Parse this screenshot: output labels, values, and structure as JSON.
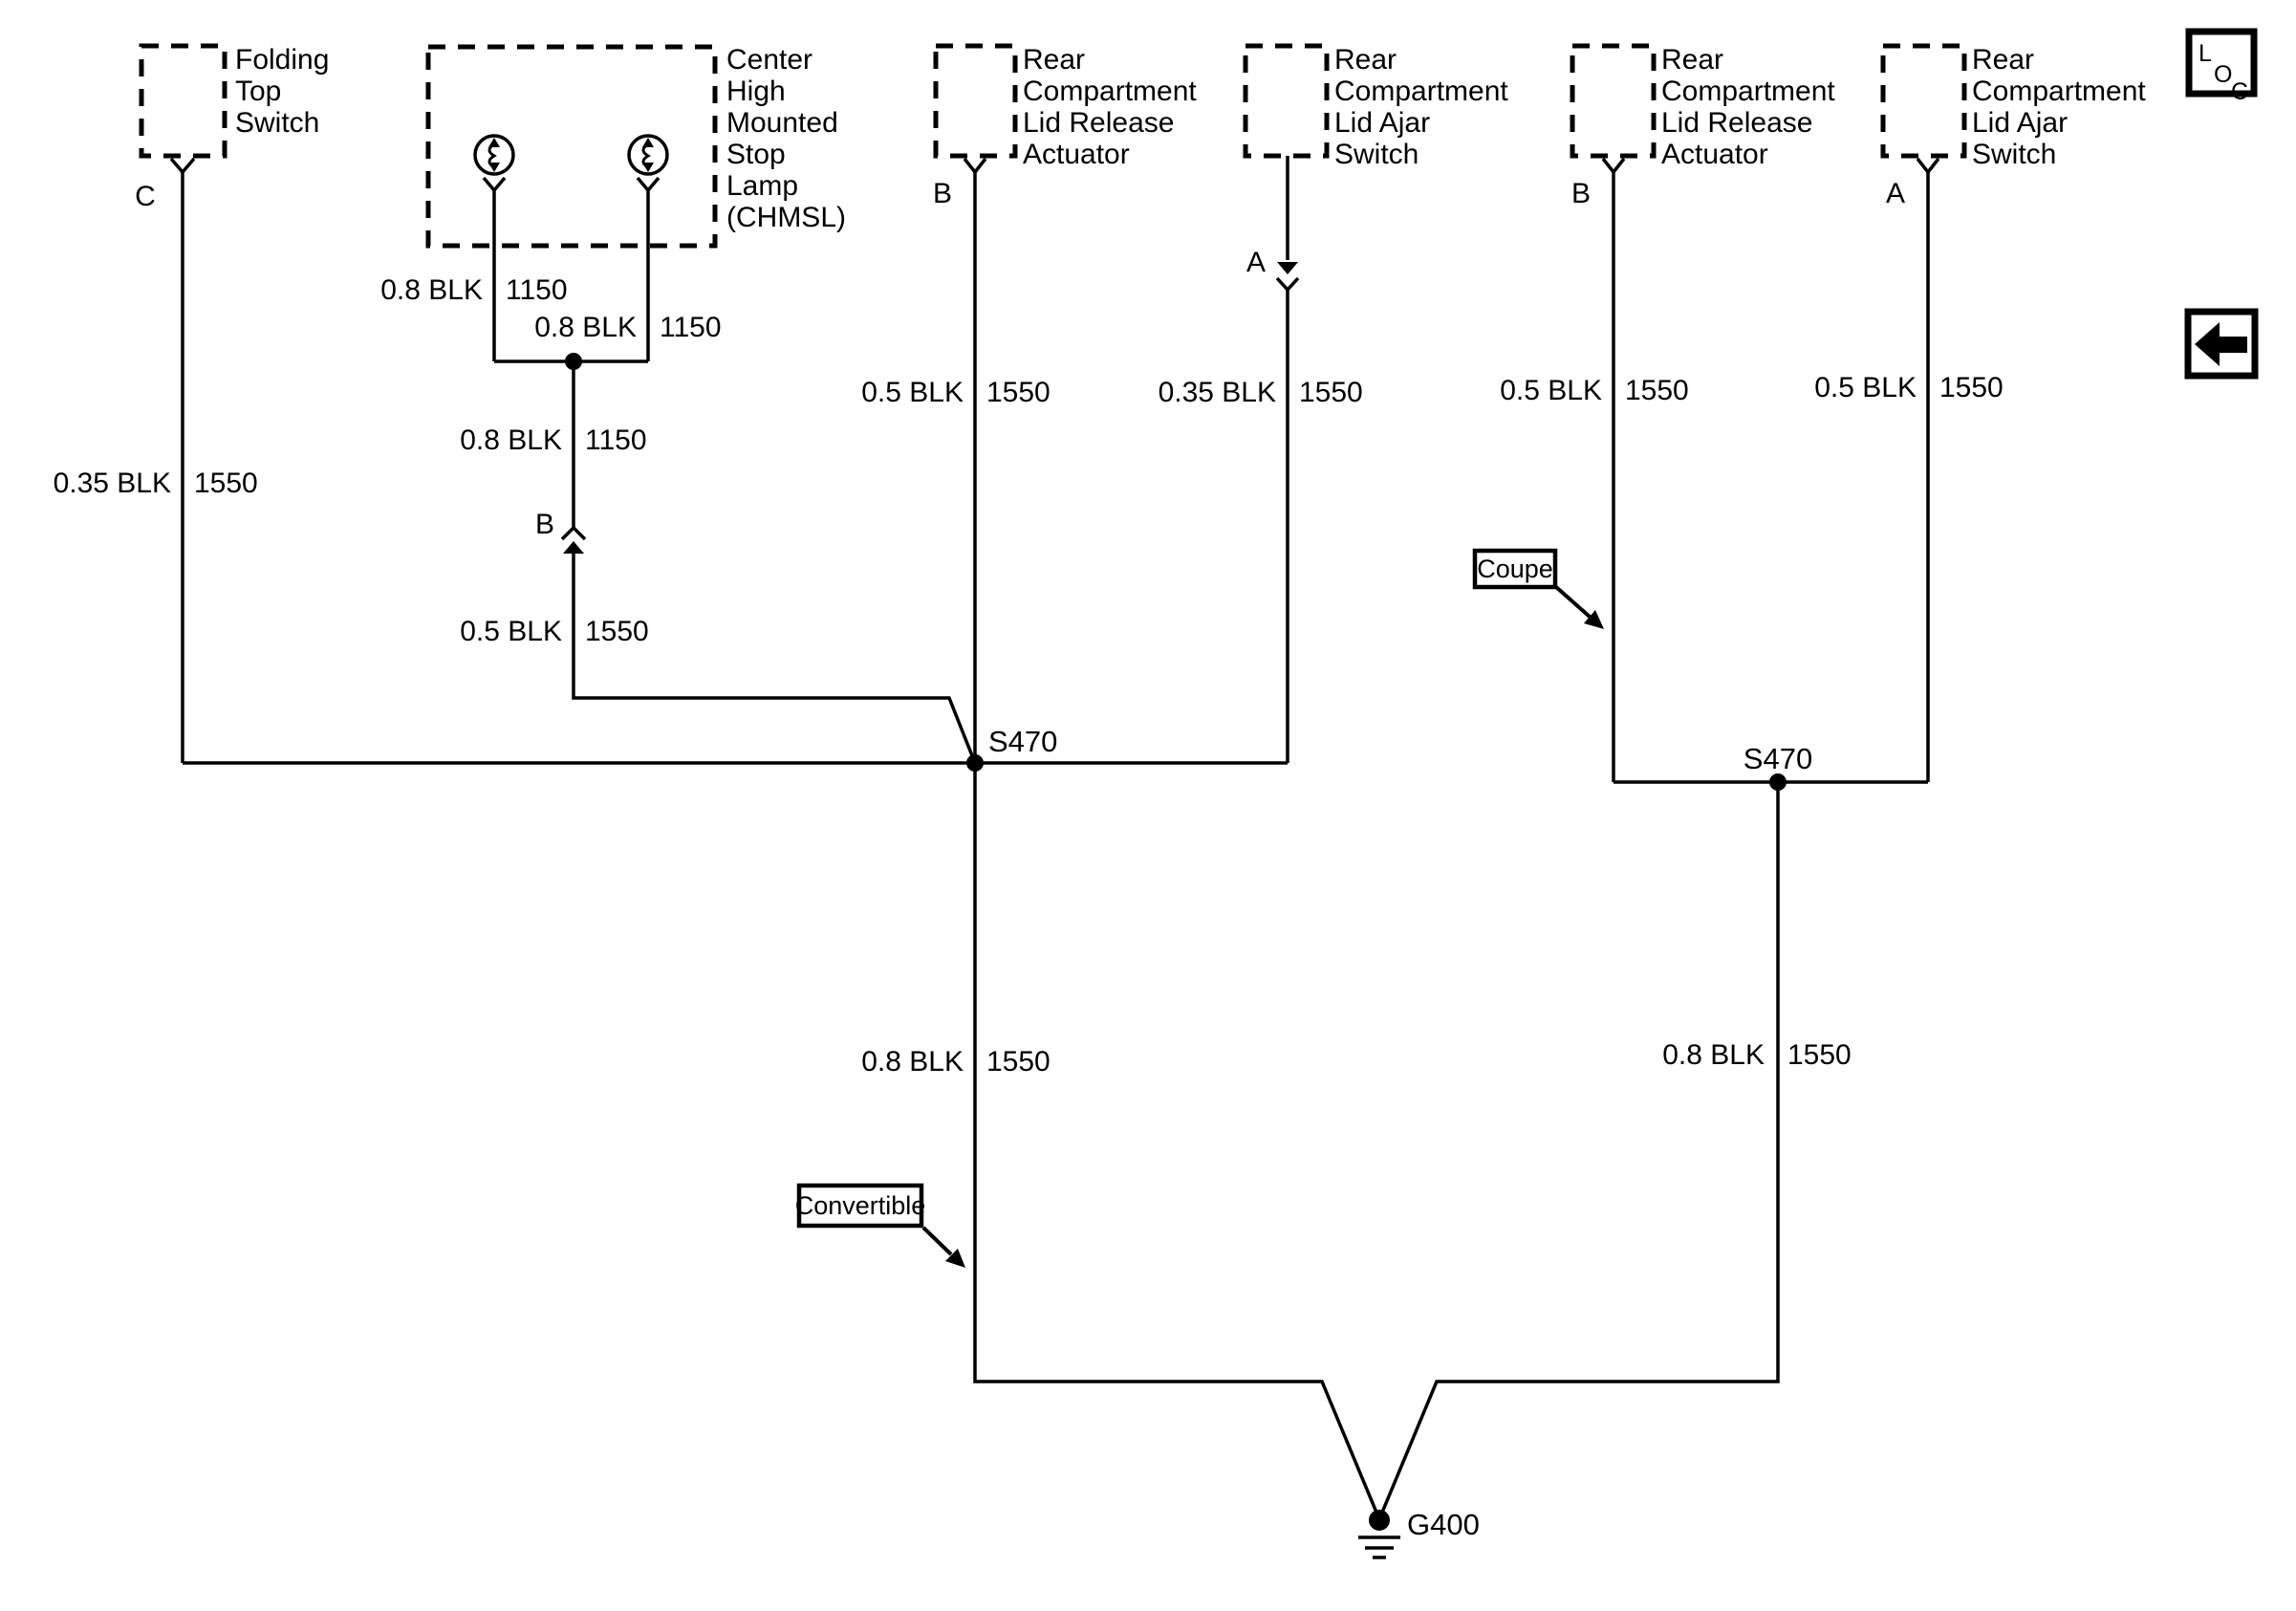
{
  "diagram": {
    "components": {
      "folding_top_switch": {
        "lines": [
          "Folding",
          "Top",
          "Switch"
        ],
        "pin": "C"
      },
      "chmsl": {
        "lines": [
          "Center",
          "High",
          "Mounted",
          "Stop",
          "Lamp",
          "(CHMSL)"
        ],
        "inline_pin": "B"
      },
      "mid_release_actuator": {
        "lines": [
          "Rear",
          "Compartment",
          "Lid Release",
          "Actuator"
        ],
        "pin": "B"
      },
      "mid_ajar_switch": {
        "lines": [
          "Rear",
          "Compartment",
          "Lid Ajar",
          "Switch"
        ],
        "inline_pin": "A"
      },
      "right_release_actuator": {
        "lines": [
          "Rear",
          "Compartment",
          "Lid Release",
          "Actuator"
        ],
        "pin": "B"
      },
      "right_ajar_switch": {
        "lines": [
          "Rear",
          "Compartment",
          "Lid Ajar",
          "Switch"
        ],
        "pin": "A"
      }
    },
    "wires": {
      "chmsl_left": {
        "size": "0.8 BLK",
        "circuit": "1150"
      },
      "chmsl_right": {
        "size": "0.8 BLK",
        "circuit": "1150"
      },
      "chmsl_joined": {
        "size": "0.8 BLK",
        "circuit": "1150"
      },
      "chmsl_to_splice": {
        "size": "0.5 BLK",
        "circuit": "1550"
      },
      "folding_top": {
        "size": "0.35 BLK",
        "circuit": "1550"
      },
      "mid_actuator": {
        "size": "0.5 BLK",
        "circuit": "1550"
      },
      "mid_ajar": {
        "size": "0.35 BLK",
        "circuit": "1550"
      },
      "right_actuator": {
        "size": "0.5 BLK",
        "circuit": "1550"
      },
      "right_ajar": {
        "size": "0.5 BLK",
        "circuit": "1550"
      },
      "convertible_ground": {
        "size": "0.8 BLK",
        "circuit": "1550"
      },
      "coupe_ground": {
        "size": "0.8 BLK",
        "circuit": "1550"
      }
    },
    "splices": {
      "left": "S470",
      "right": "S470"
    },
    "ground": {
      "name": "G400"
    },
    "callouts": {
      "coupe": "Coupe",
      "convertible": "Convertible"
    },
    "loc_icon": {
      "l": "L",
      "o": "O",
      "c": "C"
    },
    "colors": {
      "line": "#000000",
      "background": "#ffffff"
    }
  }
}
